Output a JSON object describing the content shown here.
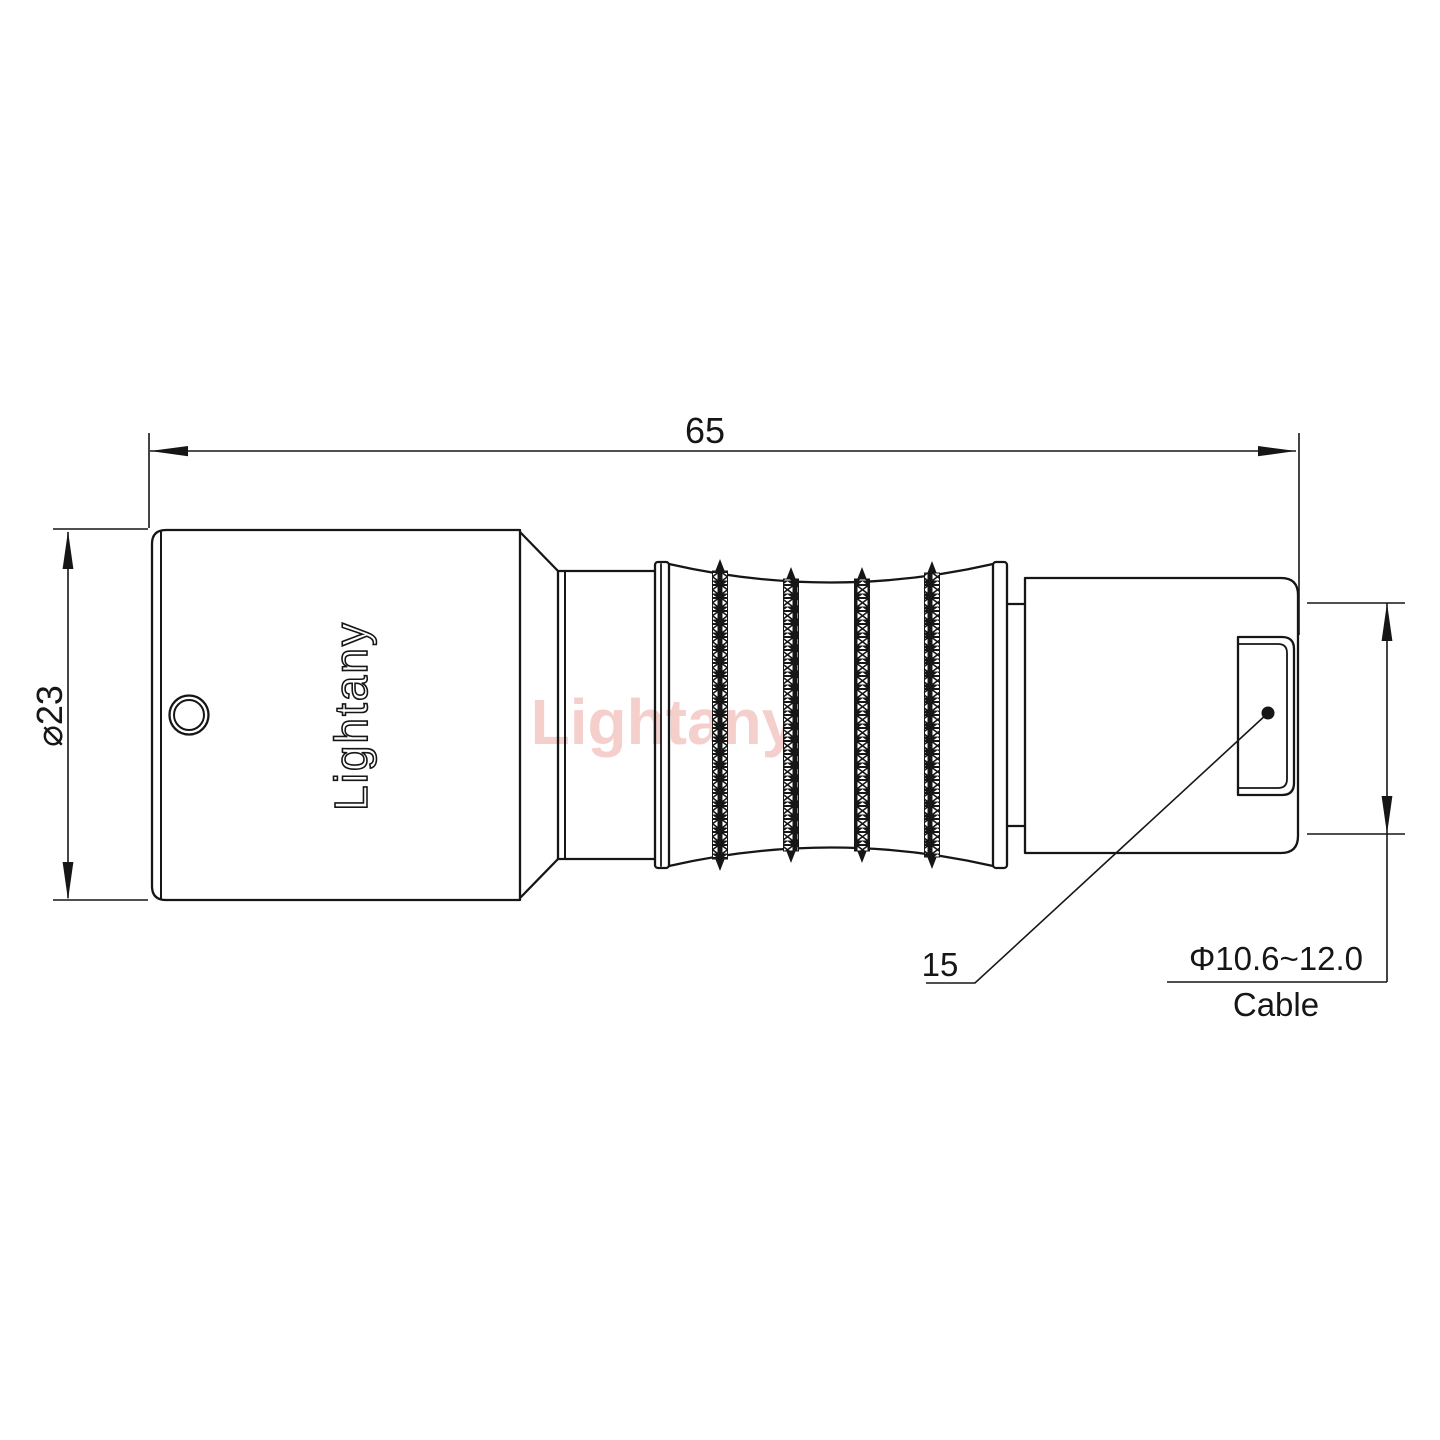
{
  "watermark": {
    "text": "Lightany",
    "color": "#eda9a4"
  },
  "part": {
    "brand_engraving": "Lightany"
  },
  "dimensions": {
    "overall_length": {
      "value": "65"
    },
    "body_diameter": {
      "value": "⌀23"
    },
    "nut_length": {
      "value": "15"
    },
    "cable": {
      "range": "Φ10.6~12.0",
      "label": "Cable"
    }
  },
  "colors": {
    "line": "#161616",
    "background": "#ffffff"
  }
}
